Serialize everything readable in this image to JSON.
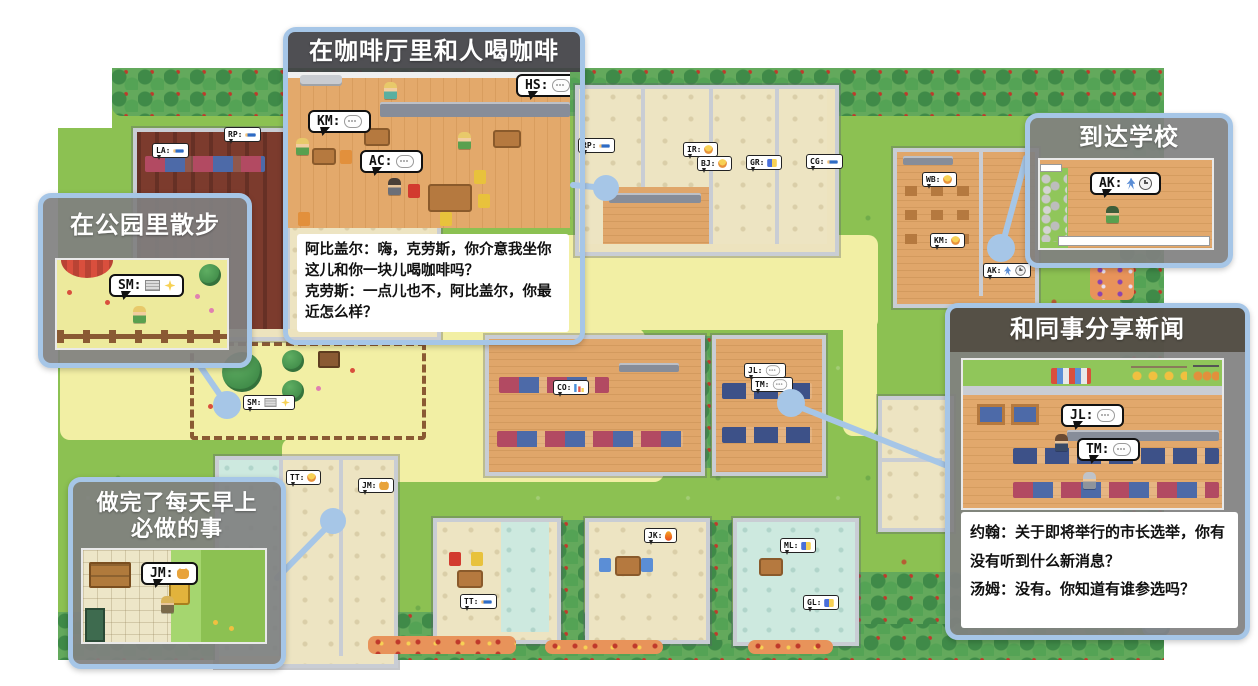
{
  "colors": {
    "accent_blue": "#A6C6E7",
    "title_bar": "#424246",
    "panel_gray": "#808080",
    "grass": "#8CC152",
    "path_yellow": "#F2EFA4",
    "bubble_border": "#111111"
  },
  "callouts": {
    "cafe": {
      "title": "在咖啡厅里和人喝咖啡",
      "bubbles": [
        {
          "label": "KM:"
        },
        {
          "label": "AC:"
        },
        {
          "label": "HS:"
        }
      ],
      "dialogue": {
        "lines": [
          "阿比盖尔：嗨，克劳斯，你介意我坐你这儿和你一块儿喝咖啡吗？",
          "克劳斯：一点儿也不，阿比盖尔，你最近怎么样？"
        ]
      }
    },
    "school": {
      "title": "到达学校",
      "bubbles": [
        {
          "label": "AK:"
        }
      ]
    },
    "park": {
      "title": "在公园里散步",
      "bubbles": [
        {
          "label": "SM:"
        }
      ]
    },
    "news": {
      "title": "和同事分享新闻",
      "bubbles": [
        {
          "label": "JL:"
        },
        {
          "label": "TM:"
        }
      ],
      "dialogue": {
        "lines": [
          "约翰：关于即将举行的市长选举，你有没有听到什么新消息？",
          "汤姆：没有。你知道有谁参选吗？"
        ]
      }
    },
    "morning": {
      "title": "做完了每天早上必做的事",
      "bubbles": [
        {
          "label": "JM:"
        }
      ]
    }
  },
  "map_agents": [
    {
      "label": "LA:",
      "icons": [
        "pencil"
      ],
      "x": 152,
      "y": 143
    },
    {
      "label": "RP:",
      "icons": [
        "pencil"
      ],
      "x": 224,
      "y": 127
    },
    {
      "label": "RP:",
      "icons": [
        "pencil"
      ],
      "x": 578,
      "y": 138
    },
    {
      "label": "IR:",
      "icons": [
        "food"
      ],
      "x": 683,
      "y": 142
    },
    {
      "label": "BJ:",
      "icons": [
        "food"
      ],
      "x": 697,
      "y": 156
    },
    {
      "label": "GR:",
      "icons": [
        "items"
      ],
      "x": 746,
      "y": 155
    },
    {
      "label": "CG:",
      "icons": [
        "pencil"
      ],
      "x": 806,
      "y": 154
    },
    {
      "label": "WB:",
      "icons": [
        "food"
      ],
      "x": 922,
      "y": 172
    },
    {
      "label": "KM:",
      "icons": [
        "food"
      ],
      "x": 930,
      "y": 233
    },
    {
      "label": "AK:",
      "icons": [
        "walk",
        "clock"
      ],
      "x": 983,
      "y": 263
    },
    {
      "label": "SM:",
      "icons": [
        "book",
        "sparkle"
      ],
      "x": 243,
      "y": 395
    },
    {
      "label": "CO:",
      "icons": [
        "chart"
      ],
      "x": 553,
      "y": 380
    },
    {
      "label": "JL:",
      "icons": [
        "chat"
      ],
      "x": 744,
      "y": 363
    },
    {
      "label": "TM:",
      "icons": [
        "chat"
      ],
      "x": 751,
      "y": 377
    },
    {
      "label": "TT:",
      "icons": [
        "food"
      ],
      "x": 286,
      "y": 470
    },
    {
      "label": "JM:",
      "icons": [
        "cat"
      ],
      "x": 358,
      "y": 478
    },
    {
      "label": "TT:",
      "icons": [
        "pencil"
      ],
      "x": 460,
      "y": 594
    },
    {
      "label": "JK:",
      "icons": [
        "fire"
      ],
      "x": 644,
      "y": 528
    },
    {
      "label": "ML:",
      "icons": [
        "items"
      ],
      "x": 780,
      "y": 538
    },
    {
      "label": "GL:",
      "icons": [
        "items"
      ],
      "x": 803,
      "y": 595
    }
  ]
}
